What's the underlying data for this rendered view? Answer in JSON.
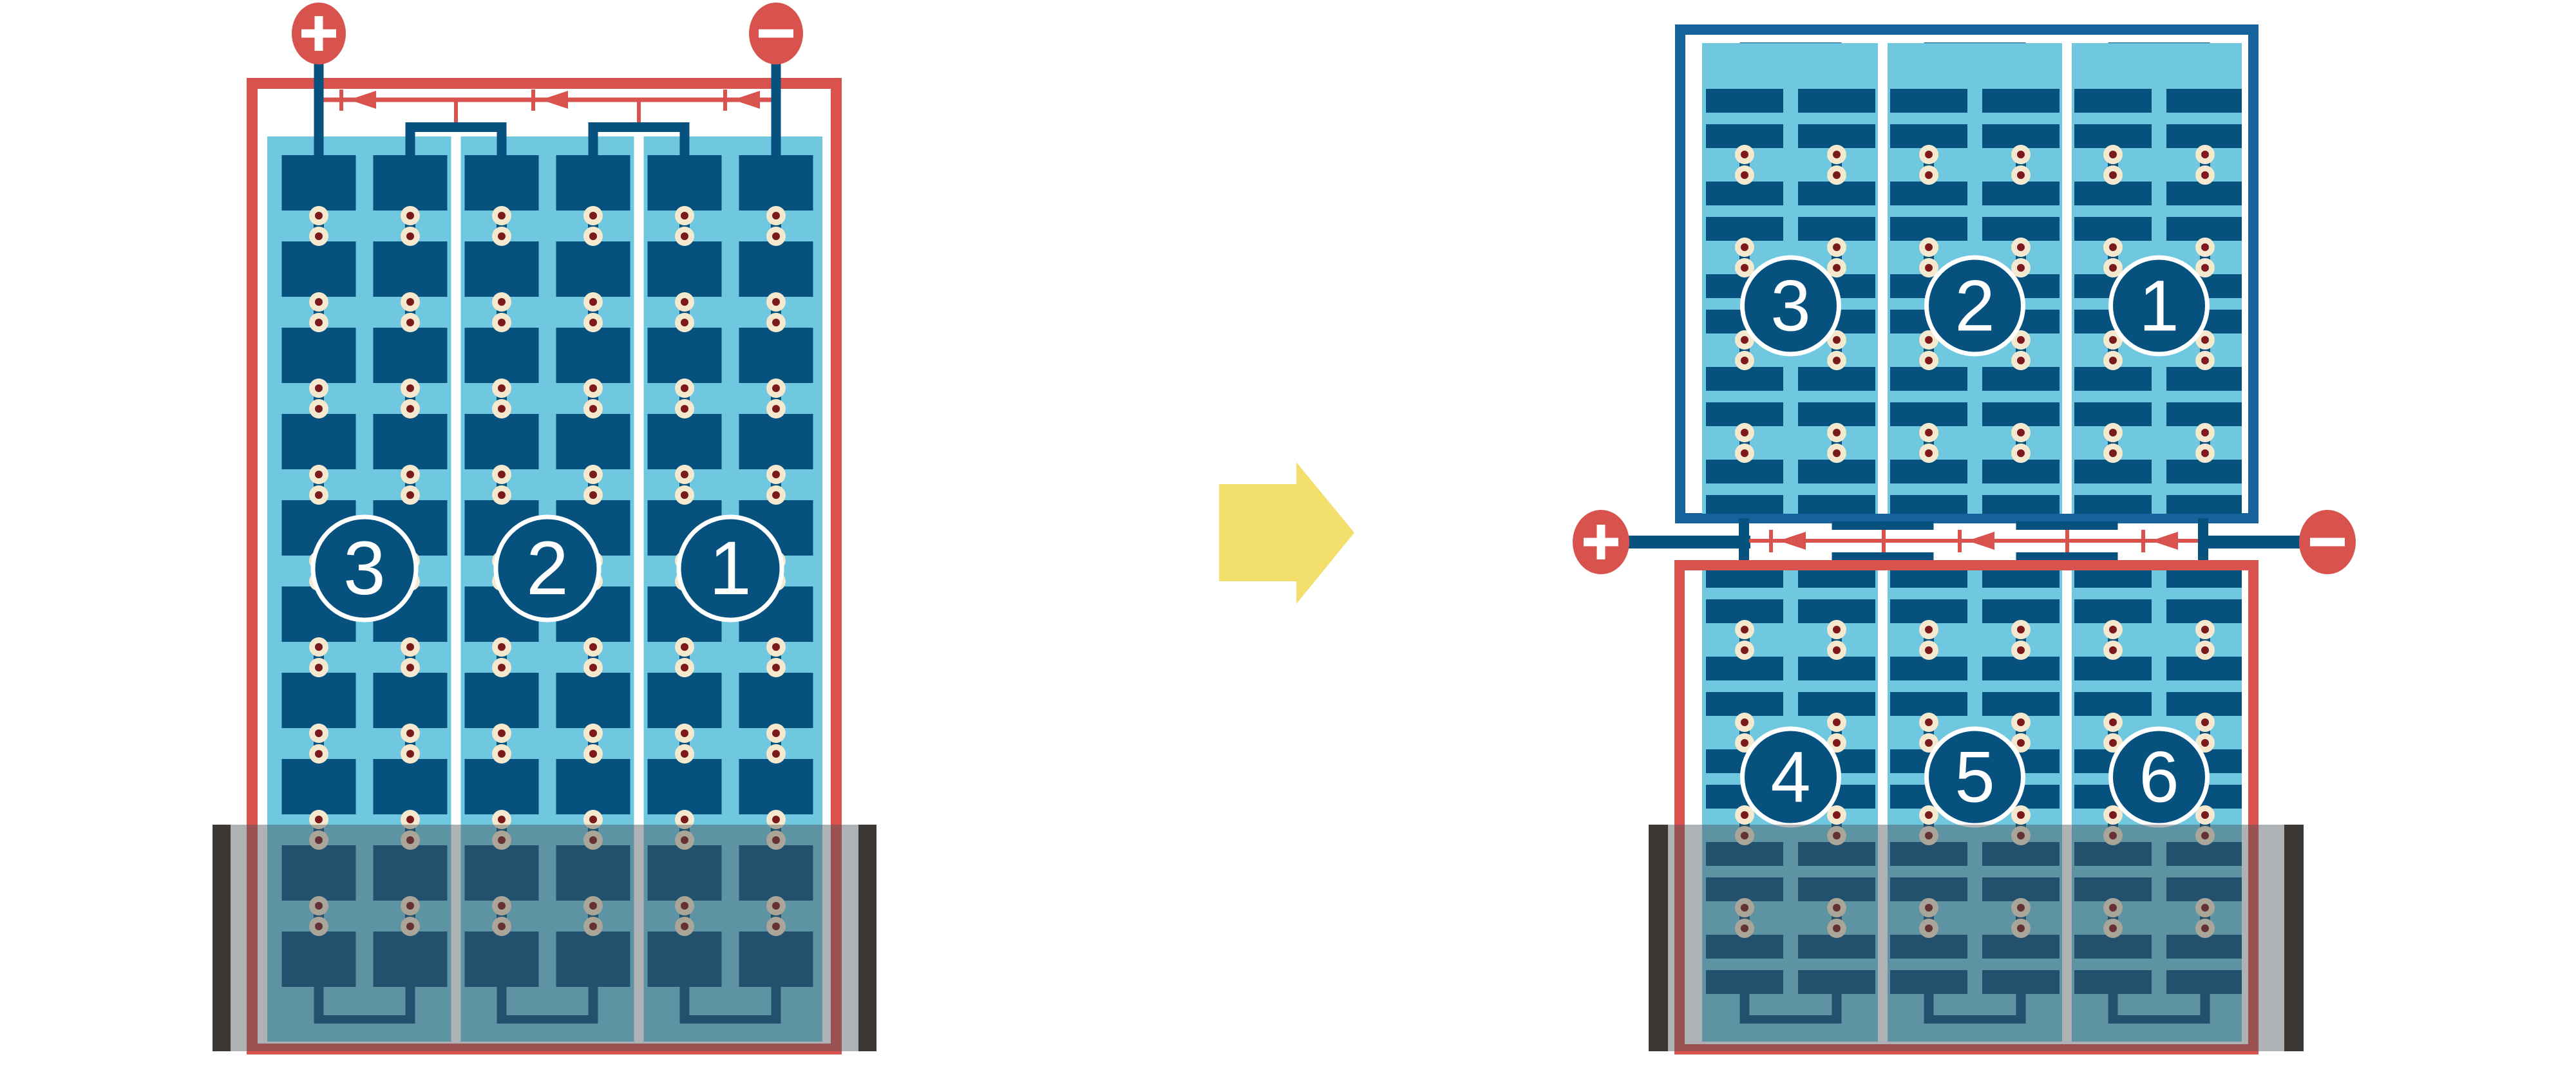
{
  "diagram": {
    "description": "battery-plate string wiring diagram, before and after re-stacking",
    "left_panel": {
      "strings": [
        {
          "label": "3"
        },
        {
          "label": "2"
        },
        {
          "label": "1"
        }
      ]
    },
    "right_top_panel": {
      "strings": [
        {
          "label": "3"
        },
        {
          "label": "2"
        },
        {
          "label": "1"
        }
      ]
    },
    "right_bottom_panel": {
      "strings": [
        {
          "label": "4"
        },
        {
          "label": "5"
        },
        {
          "label": "6"
        }
      ]
    },
    "terminals": {
      "positive": "+",
      "negative": "-"
    },
    "colors": {
      "red": "#D8534E",
      "dark_blue": "#07517F",
      "frame_blue": "#15629D",
      "light_blue": "#6FC8DF",
      "cream": "#F4E8CE",
      "dot_red": "#7C191C",
      "tank_gray": "#3B3735",
      "water_overlay": "rgba(72,80,86,0.44)",
      "arrow_yellow": "#F3DF6C",
      "white": "#FFFFFF"
    }
  }
}
